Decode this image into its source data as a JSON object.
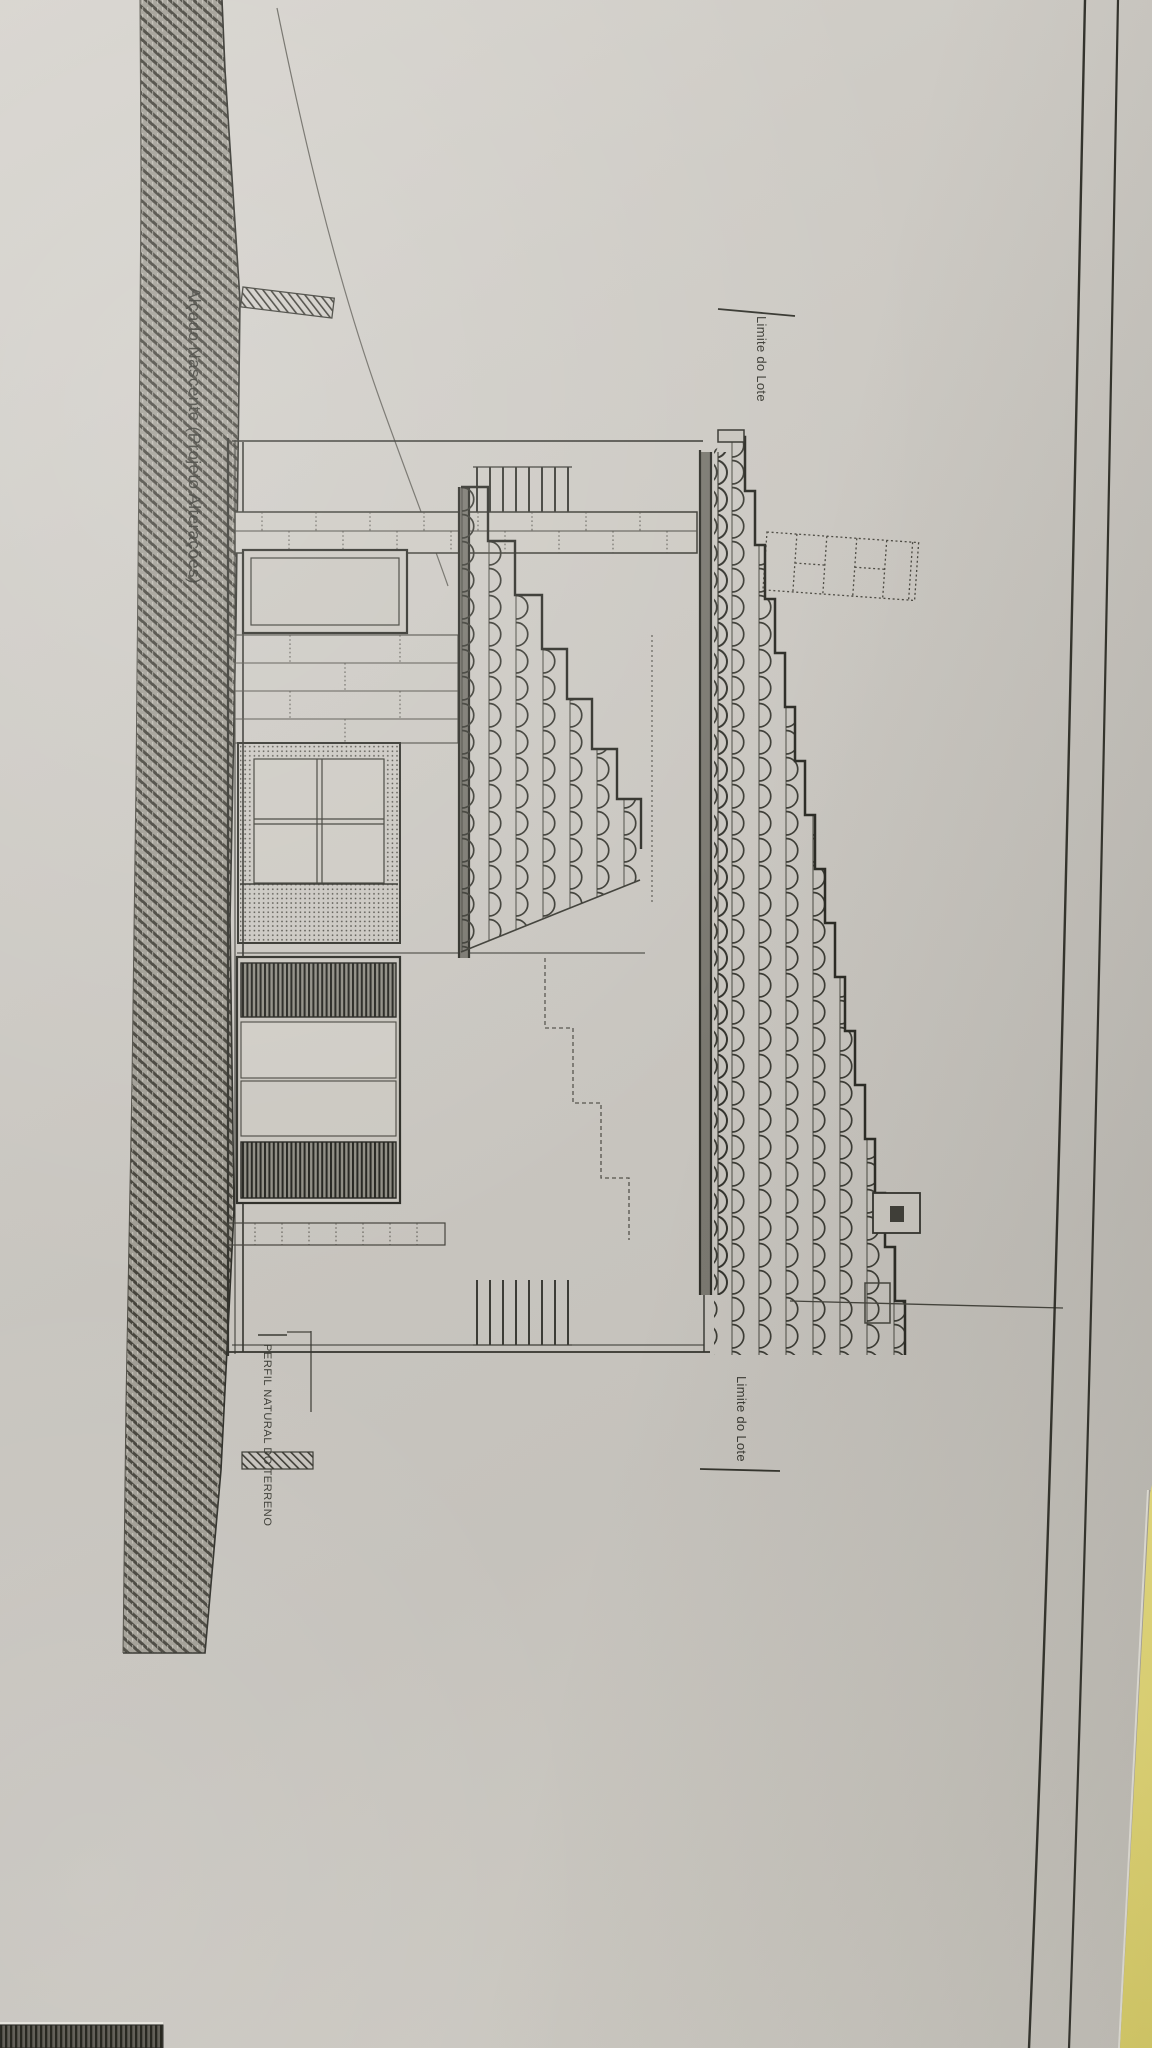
{
  "drawing": {
    "title": "Alçado Nascente (Projeto Alterações)",
    "labels": {
      "lot_boundary_top": "Limite do Lote",
      "lot_boundary_bottom": "Limite do Lote",
      "terrain_profile": "PERFIL NATURAL DO TERRENO"
    },
    "colors": {
      "paper": "#cac7c0",
      "ink": "#33332d",
      "ground_hatch_base": "#a19e95",
      "ground_hatch_line": "#44423a",
      "yellow_backing": "#eee27b",
      "dark_underlay": "#2a2925"
    }
  }
}
